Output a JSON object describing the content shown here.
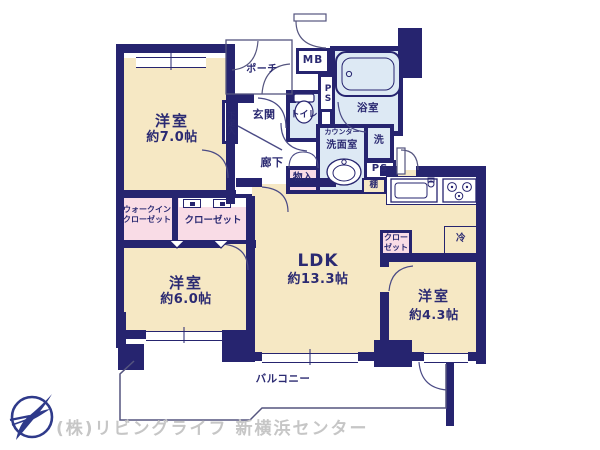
{
  "colors": {
    "wall": "#26246f",
    "room_floor": "#f6e8c4",
    "wet_area": "#dde9f4",
    "closet_pink": "#f9dce6",
    "thin_outline": "#55557f",
    "label_navy": "#2b2a72",
    "watermark_gray": "#c6c6c6"
  },
  "rooms": {
    "room7": {
      "name": "洋室",
      "size": "約7.0帖"
    },
    "room6": {
      "name": "洋室",
      "size": "約6.0帖"
    },
    "room43": {
      "name": "洋室",
      "size": "約4.3帖"
    },
    "ldk": {
      "name": "LDK",
      "size": "約13.3帖"
    }
  },
  "labels": {
    "entrance": "玄関",
    "porch": "ポーチ",
    "hallway": "廊下",
    "toilet": "トイレ",
    "bathroom": "浴室",
    "washroom": "洗面室",
    "counter": "カウンター",
    "laundry": "洗",
    "walk_in_closet": "ウォークイン\nクローゼット",
    "closet": "クローゼット",
    "closet_small": "クロー\nゼット",
    "storage": "物入",
    "shoe_cabinet": "下足入",
    "shelf": "棚",
    "refrigerator": "冷",
    "meter_box": "MB",
    "pipe_space_upper": "PS",
    "pipe_space_lower": "PS",
    "balcony": "バルコニー"
  },
  "footer": {
    "company": "(株)リビングライフ 新横浜センター"
  }
}
